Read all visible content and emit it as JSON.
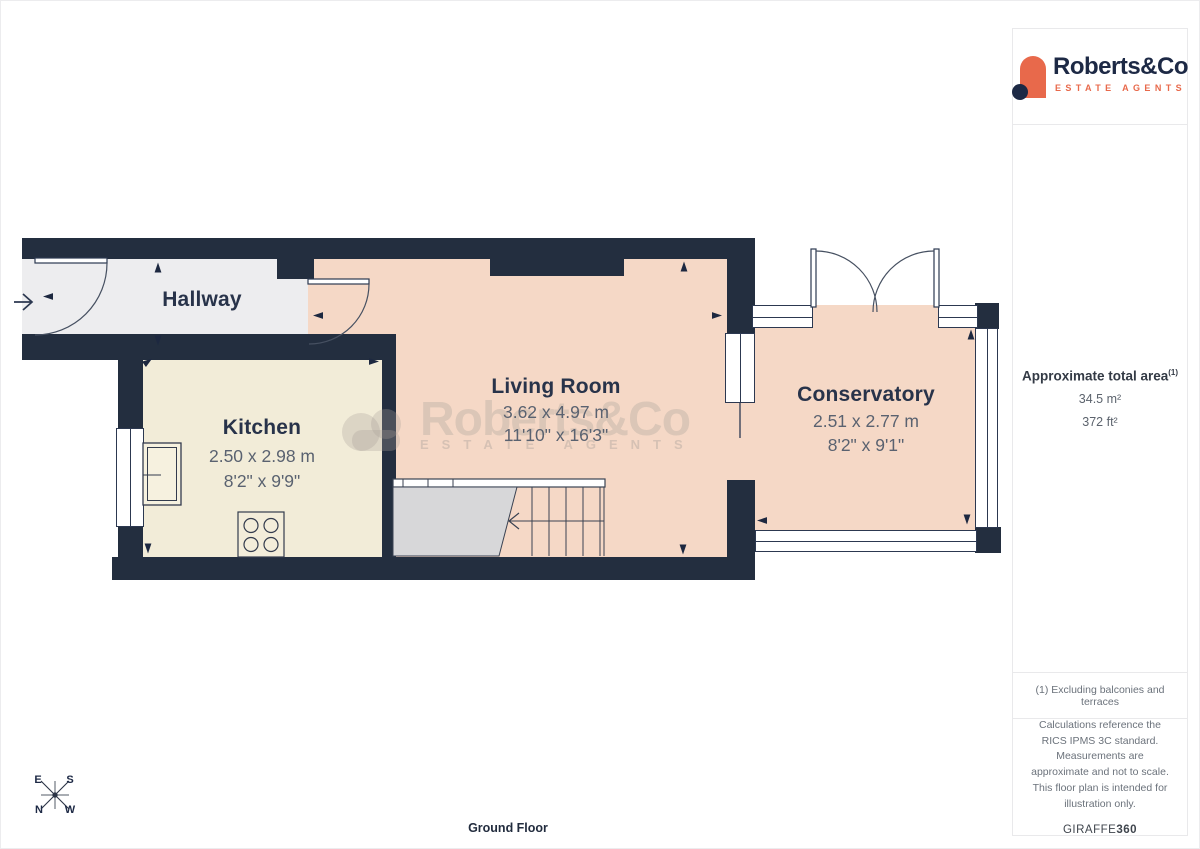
{
  "logo": {
    "name": "Roberts&Co",
    "tagline": "ESTATE AGENTS"
  },
  "watermark": {
    "name": "Roberts&Co",
    "tagline": "ESTATE AGENTS"
  },
  "plan": {
    "rooms": [
      {
        "name": "Hallway",
        "metric": "",
        "imperial": ""
      },
      {
        "name": "Kitchen",
        "metric": "2.50 x 2.98 m",
        "imperial": "8'2\" x 9'9\""
      },
      {
        "name": "Living Room",
        "metric": "3.62 x 4.97 m",
        "imperial": "11'10\" x 16'3\""
      },
      {
        "name": "Conservatory",
        "metric": "2.51 x 2.77 m",
        "imperial": "8'2\" x 9'1\""
      }
    ],
    "floor_label": "Ground Floor",
    "compass": {
      "e": "E",
      "s": "S",
      "n": "N",
      "w": "W"
    }
  },
  "sidebar": {
    "area_title": "Approximate total area",
    "area_note_ref": "(1)",
    "area_metric": "34.5 m²",
    "area_imperial": "372 ft²",
    "footnote": "(1) Excluding balconies and terraces",
    "disclaimer": "Calculations reference the RICS IPMS 3C standard. Measurements are approximate and not to scale. This floor plan is intended for illustration only.",
    "brand": "GIRAFFE",
    "brand_bold": "360"
  },
  "colors": {
    "wall": "#232e3f",
    "hallway_floor": "#ededef",
    "kitchen_floor": "#f2ecd8",
    "living_floor": "#f5d8c6",
    "understair_gray": "#d7d7d9",
    "brand_navy": "#1d2945",
    "brand_orange": "#e8694b",
    "dim_text": "#5a6270"
  },
  "icons": [
    "camera-marker-icon",
    "entrance-arrow-icon",
    "compass-icon",
    "sink-icon",
    "hob-icon",
    "door-arc-icon",
    "cloud-icon",
    "logo-arch-icon"
  ]
}
